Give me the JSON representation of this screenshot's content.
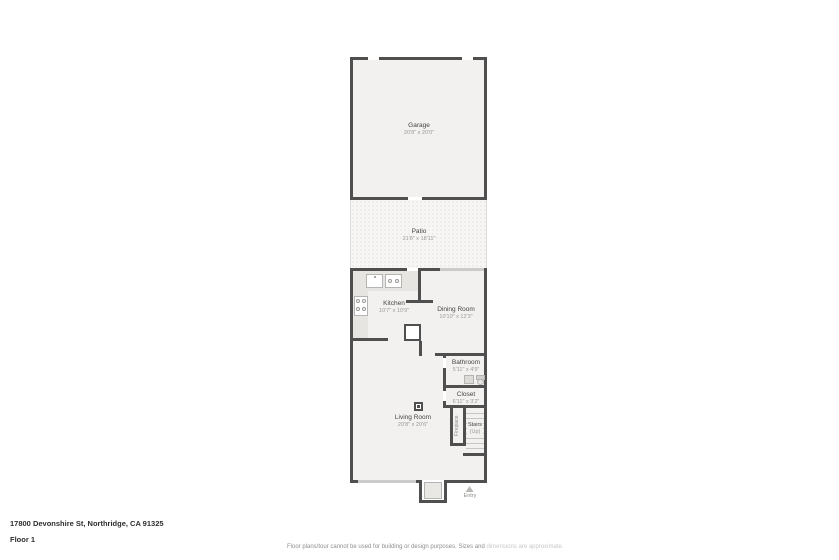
{
  "footer": {
    "address": "17800 Devonshire St, Northridge, CA 91325",
    "floor_label": "Floor 1",
    "disclaimer_main": "Floor plans/tour cannot be used for building or design purposes. Sizes and ",
    "disclaimer_fade": "dimensions are approximate."
  },
  "rooms": {
    "garage": {
      "name": "Garage",
      "dims": "20'8\" x 20'0\""
    },
    "patio": {
      "name": "Patio",
      "dims": "21'8\" x 18'11\""
    },
    "kitchen": {
      "name": "Kitchen",
      "dims": "10'7\" x 10'9\""
    },
    "dining": {
      "name": "Dining Room",
      "dims": "10'10\" x 12'3\""
    },
    "bathroom": {
      "name": "Bathroom",
      "dims": "5'11\" x 4'9\""
    },
    "closet": {
      "name": "Closet",
      "dims": "6'11\" x 3'2\""
    },
    "living": {
      "name": "Living Room",
      "dims": "20'8\" x 20'6\""
    },
    "fireplace": {
      "name": "Fireplace"
    },
    "stairs": {
      "name": "Stairs",
      "direction": "(Up)"
    },
    "entry": {
      "name": "Entry"
    }
  },
  "colors": {
    "wall": "#4f4f4f",
    "room_fill": "#f2f1ef",
    "label_text": "#454545",
    "dim_text": "#9a9998"
  }
}
